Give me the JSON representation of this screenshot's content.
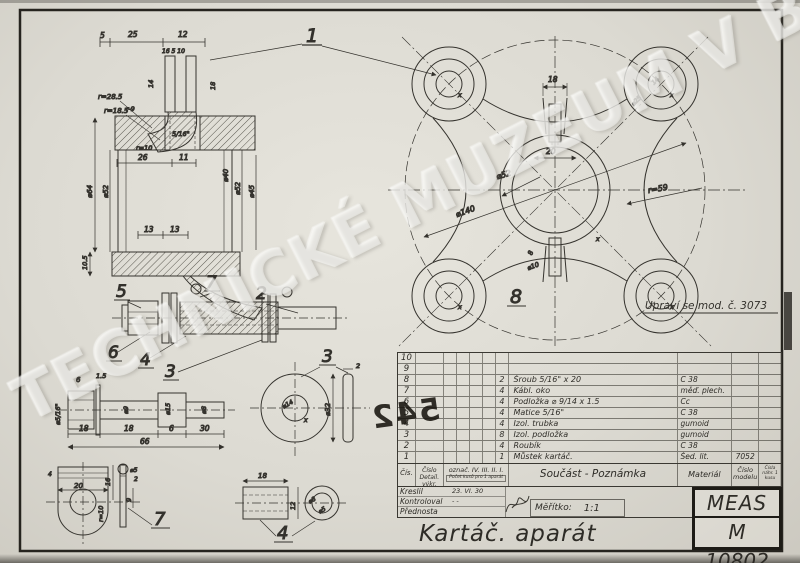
{
  "watermark": "TECHNICKÉ MUZEUM V BRNĚ",
  "note": "Upraví se mod. č. 3073",
  "stamp": "542",
  "x_mark": "x",
  "colors": {
    "paper": "#dcdad2",
    "ink": "#33312c"
  },
  "callouts": {
    "n1": "1",
    "n2": "2",
    "n3": "3",
    "n4": "4",
    "n5": "5",
    "n6": "6",
    "n7": "7",
    "n8": "8",
    "disc": "3",
    "bracket": "7",
    "tube": "4"
  },
  "dims": {
    "tl": {
      "a": "5",
      "b": "25",
      "c": "12",
      "small": "16 5 10",
      "left": "14",
      "right": "18",
      "r1": "r=28.5",
      "r2": "r=18.5",
      "r3": "r-9",
      "thread": "5/16\"",
      "r4": "r=10",
      "w1": "26",
      "w2": "11"
    },
    "cyl": {
      "d64": "⌀64",
      "d52l": "⌀52",
      "d40": "⌀40",
      "d52r": "⌀52",
      "d45": "⌀45",
      "t13a": "13",
      "t13b": "13",
      "h105": "10.5"
    },
    "main": {
      "top": "18",
      "mid": "20",
      "d52": "⌀52",
      "d140": "⌀140",
      "r59": "r=59",
      "d25": "⌀25",
      "d14": "14",
      "b8": "8",
      "b10": "⌀10"
    },
    "shaft": {
      "t6": "6",
      "t15": "1.5",
      "thr": "⌀5/16\"",
      "d9": "⌀9",
      "d15": "⌀15",
      "d8": "⌀8",
      "l1": "18",
      "l2": "18",
      "l3": "6",
      "l4": "30",
      "tot": "66"
    },
    "disc": {
      "d32": "⌀32",
      "hole": "⌀14",
      "t": "2"
    },
    "br": {
      "w": "20",
      "t4": "4",
      "h16": "16",
      "r10": "r=10",
      "d5": "⌀5",
      "h9": "9",
      "t2": "2"
    },
    "tube": {
      "l": "18",
      "d12": "12",
      "d8": "⌀8",
      "d5": "⌀5"
    }
  },
  "parts_table": {
    "rows": [
      {
        "no": "10",
        "qty": "",
        "name": "",
        "mat": "",
        "model": ""
      },
      {
        "no": "9",
        "qty": "",
        "name": "",
        "mat": "",
        "model": ""
      },
      {
        "no": "8",
        "qty": "2",
        "name": "Šroub 5/16\" x 20",
        "mat": "C 38",
        "model": ""
      },
      {
        "no": "7",
        "qty": "4",
        "name": "Kábl. oko",
        "mat": "měď. plech.",
        "model": ""
      },
      {
        "no": "6",
        "qty": "4",
        "name": "Podložka ⌀ 9/14 x 1.5",
        "mat": "Cc",
        "model": ""
      },
      {
        "no": "5",
        "qty": "4",
        "name": "Matice 5/16\"",
        "mat": "C 38",
        "model": ""
      },
      {
        "no": "4",
        "qty": "4",
        "name": "Izol. trubka",
        "mat": "gumoid",
        "model": ""
      },
      {
        "no": "3",
        "qty": "8",
        "name": "Izol. podložka",
        "mat": "gumoid",
        "model": ""
      },
      {
        "no": "2",
        "qty": "4",
        "name": "Roubík",
        "mat": "C 38",
        "model": ""
      },
      {
        "no": "1",
        "qty": "1",
        "name": "Můstek kartáč.",
        "mat": "Šed. lit.",
        "model": "7052"
      }
    ]
  },
  "title_block": {
    "cis": "Čís.",
    "cislo": "Číslo",
    "detail": "Detail. výkr.",
    "oznac": "označ. IV. III. II. I.",
    "pocet": "Počet kusů pro 1 aparát",
    "soucast": "Součást - Poznámka",
    "material": "Materiál",
    "cislo_modelu": "Číslo modelu",
    "cisla_nahr": "Čísla náhr. 1 kusu",
    "kreslil": "Kreslil",
    "kreslil_date": "23. VI. 30",
    "kontroloval": "Kontroloval",
    "kontroloval_val": "- -",
    "prednosta": "Přednosta",
    "meritko_label": "Měřítko:",
    "meritko_value": "1:1",
    "title": "Kartáč. aparát",
    "company": "MEAS",
    "drawing_no": "M 10802"
  }
}
